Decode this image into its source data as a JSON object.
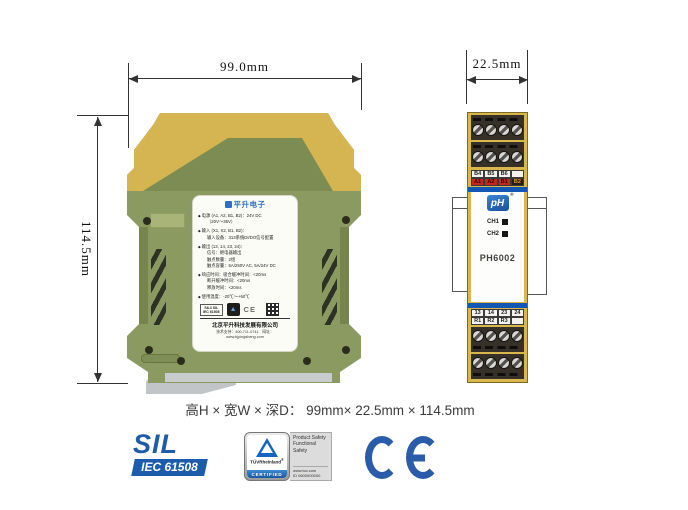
{
  "dimensions": {
    "width": "99.0mm",
    "depth": "22.5mm",
    "height": "114.5mm",
    "caption": "高H × 宽W × 深D：  99mm× 22.5mm × 114.5mm"
  },
  "side_view": {
    "label": {
      "brand": "平升电子",
      "specs": [
        {
          "title": "电源 (A1, A2, B1, B2)：24V DC",
          "lines": [
            "（20V～35V）"
          ]
        },
        {
          "title": "输入 (X1, X2, B1, B2)：",
          "lines": [
            "输入设备：313系统DI/DO信号配置"
          ]
        },
        {
          "title": "输出 (13, 14, 23, 24)：",
          "lines": [
            "信号：继电器输出",
            "触点数量：2组",
            "触点容量：5A/250V AC, 5A/24V DC"
          ]
        },
        {
          "title": "响应时间：吸合缓冲时间：<20ms",
          "lines": [
            "断开缓冲时间：<20ms",
            "释放时间：<20ms"
          ]
        },
        {
          "title": "使用温度：-20℃～+60℃",
          "lines": []
        }
      ],
      "mini_sil_line1": "SIL3 SIL",
      "mini_sil_line2": "IEC 61508",
      "mini_ce": "CE",
      "company": "北京平升科技发展有限公司",
      "contact": "技术支持：400-711-0741　网址：www.bjpingsheng.com"
    }
  },
  "front_view": {
    "brand": "pH",
    "brand_mark": "®",
    "model": "PH6002",
    "channels": [
      "CH1",
      "CH2"
    ],
    "top_terminals": {
      "row1": [
        "B4",
        "B5",
        "B6",
        ""
      ],
      "row2": [
        "A1",
        "A2",
        "B1",
        "B2"
      ]
    },
    "bottom_terminals": {
      "row1": [
        "13",
        "14",
        "23",
        "24"
      ],
      "row2": [
        "R1",
        "R2",
        "R3",
        ""
      ]
    }
  },
  "badges": {
    "sil_title": "SIL",
    "sil_subtitle": "IEC 61508",
    "tuv_brand": "TÜVRheinland",
    "tuv_mark": "®",
    "tuv_certified": "CERTIFIED",
    "tuv_right_lines": [
      "Product Safety",
      "Functional",
      "Safety"
    ],
    "tuv_site": "www.tuv.com",
    "tuv_id": "ID 0600000000",
    "ce": "CE"
  },
  "colors": {
    "accent_blue": "#1d5bab",
    "device_yellow": "#d5b551",
    "device_olive": "#8a9a60",
    "strip_blue": "#1257b5",
    "cell_red": "#c5261f"
  }
}
